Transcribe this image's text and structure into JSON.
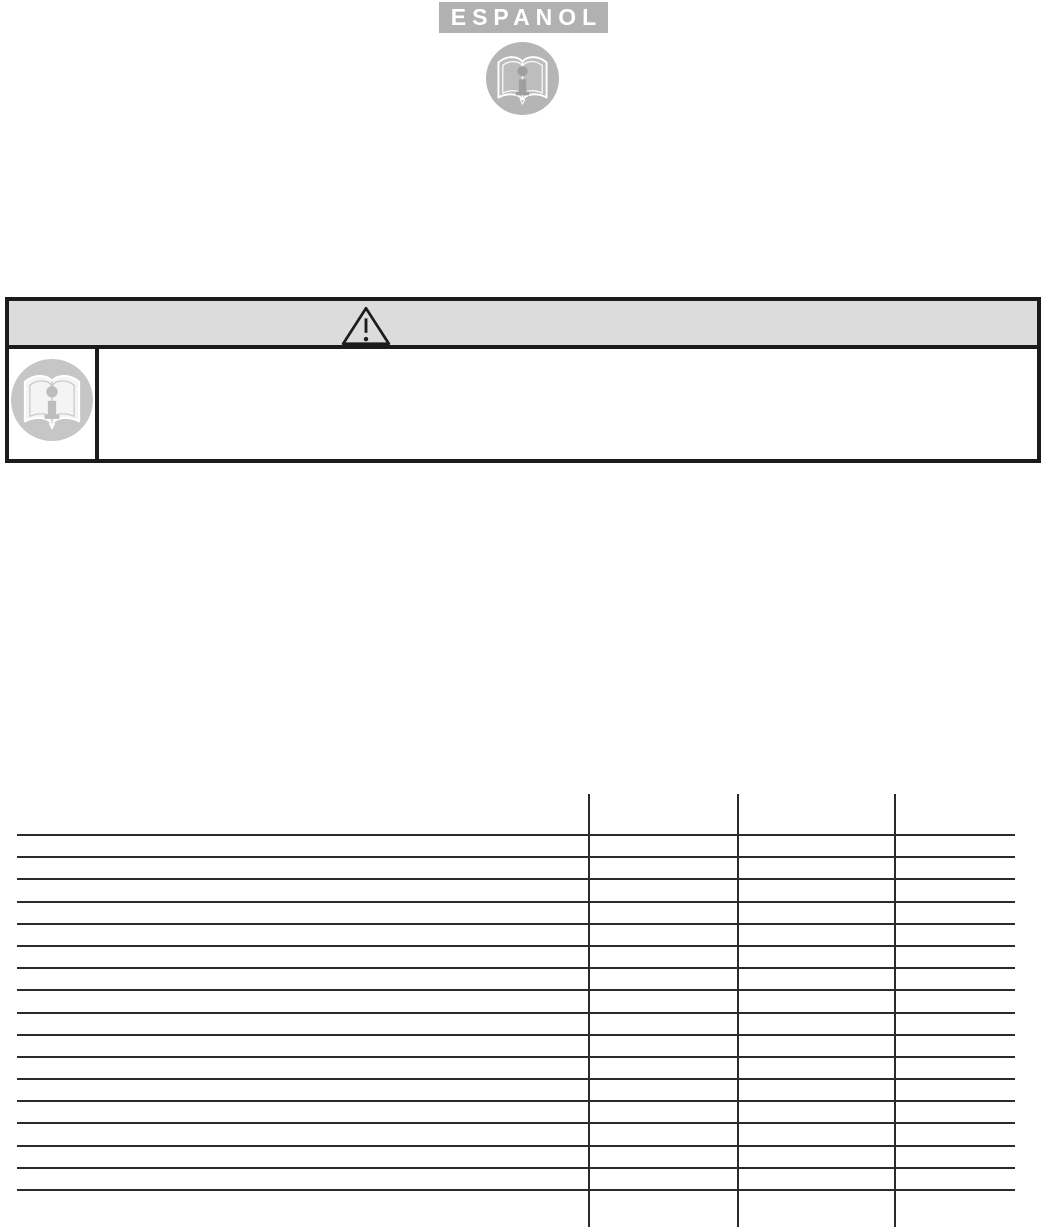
{
  "page": {
    "language_label": "ESPANOL",
    "background": "#ffffff"
  },
  "colors": {
    "banner_gray": "#b1b1b1",
    "banner_text_white": "#ffffff",
    "warning_bar_gray": "#dcdcdc",
    "box_border_black": "#1b1b1b",
    "table_line_black": "#2b2b2b",
    "icon_circle_gray": "#b5b5b5",
    "icon_ellipse_light_gray": "#c6c6c6",
    "icon_book_outline_white": "#ffffff",
    "icon_i_gray": "#9e9e9e"
  },
  "icons": {
    "top": "open-book-info-icon",
    "warning": "warning-triangle-icon",
    "note": "open-book-info-icon"
  },
  "warning_box": {
    "header_text": "",
    "note_text": ""
  },
  "table": {
    "column_count": 4,
    "row_count": 16,
    "headers": [
      "",
      "",
      "",
      ""
    ],
    "cells_empty": true
  }
}
